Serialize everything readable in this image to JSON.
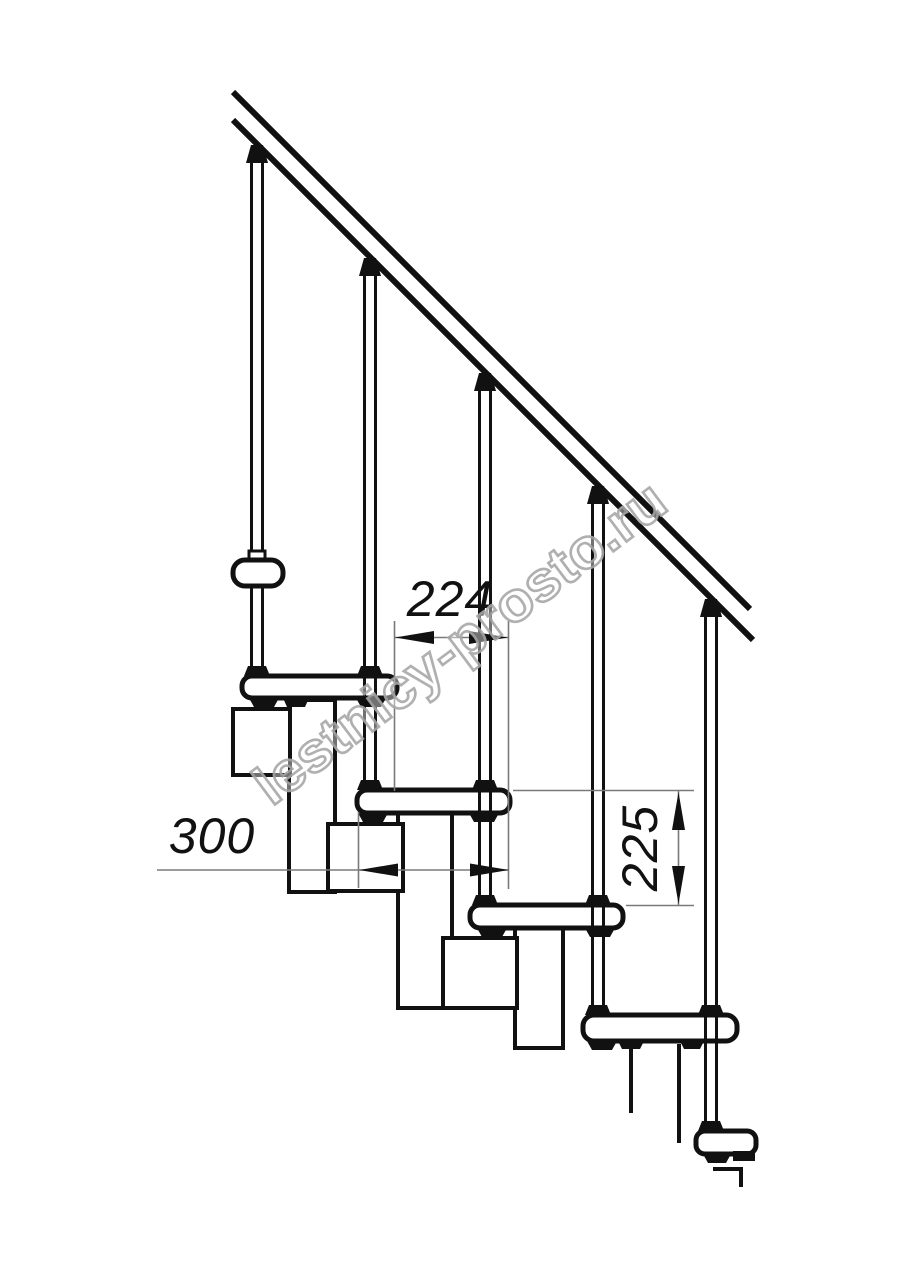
{
  "title": "Modular staircase side-view drawing",
  "watermark": {
    "text": "lestnicy-prosto.ru"
  },
  "dimensions": {
    "run": {
      "label": "224"
    },
    "depth": {
      "label": "300"
    },
    "rise": {
      "label": "225"
    }
  },
  "colors": {
    "background": "#ffffff",
    "line": "#111111",
    "dim_line": "#7a7a7a",
    "watermark_stroke": "#a8a8a8"
  }
}
